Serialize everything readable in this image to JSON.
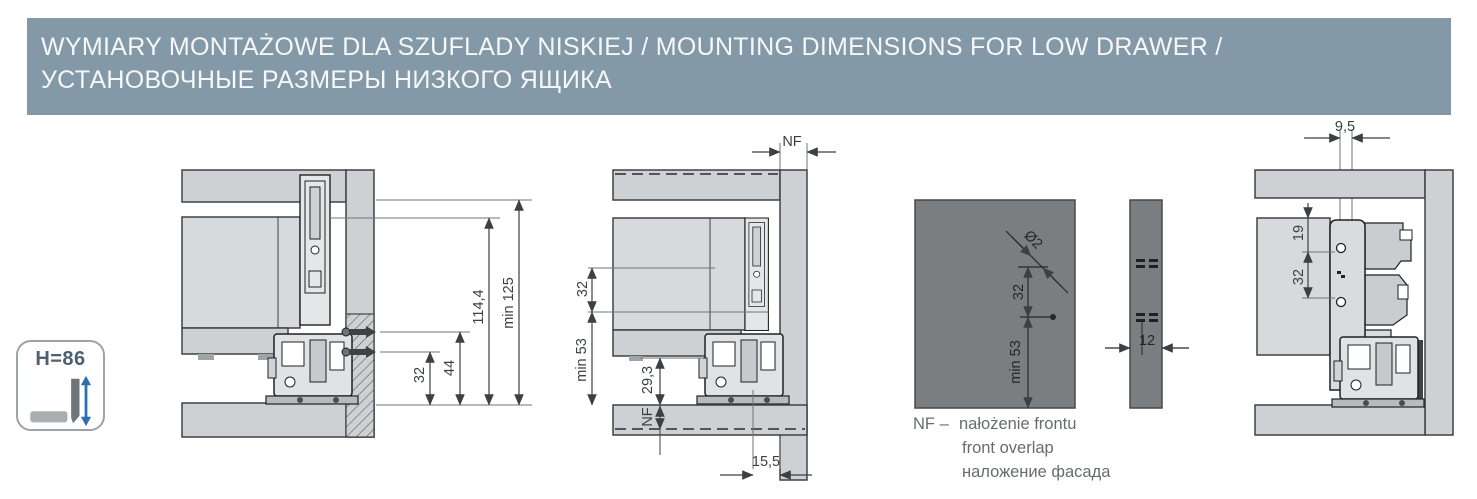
{
  "header": {
    "title_line1": "WYMIARY MONTAŻOWE DLA SZUFLADY NISKIEJ / MOUNTING DIMENSIONS FOR LOW DRAWER /",
    "title_line2": "УСТАНОВОЧНЫЕ РАЗМЕРЫ НИЗКОГО ЯЩИКА"
  },
  "badge": {
    "height_label": "H=86"
  },
  "section_view_mounted": {
    "dim_32": "32",
    "dim_44": "44",
    "dim_114_4": "114,4",
    "dim_min_125": "min 125"
  },
  "section_view_overlay": {
    "dim_nf_top": "NF",
    "dim_32": "32",
    "dim_min_53": "min 53",
    "dim_29_3": "29,3",
    "dim_nf_bottom": "NF",
    "dim_15_5": "15,5"
  },
  "front_panel_drilling": {
    "dim_hole_diameter": "Ø2",
    "dim_32": "32",
    "dim_min_53": "min 53",
    "dim_12": "12"
  },
  "nf_legend": {
    "term": "NF –",
    "definition_pl": "nałożenie frontu",
    "definition_en": "front overlap",
    "definition_ru": "наложение фасада"
  },
  "bracket_view": {
    "dim_9_5": "9,5",
    "dim_19": "19",
    "dim_32": "32"
  },
  "colors": {
    "header_bg": "#8399A7",
    "panel_light": "#CDD1D3",
    "drawer_light": "#D6DADC",
    "panel_dark": "#7B7E81",
    "line": "#3C4043",
    "accent_blue": "#2E6FAE"
  }
}
